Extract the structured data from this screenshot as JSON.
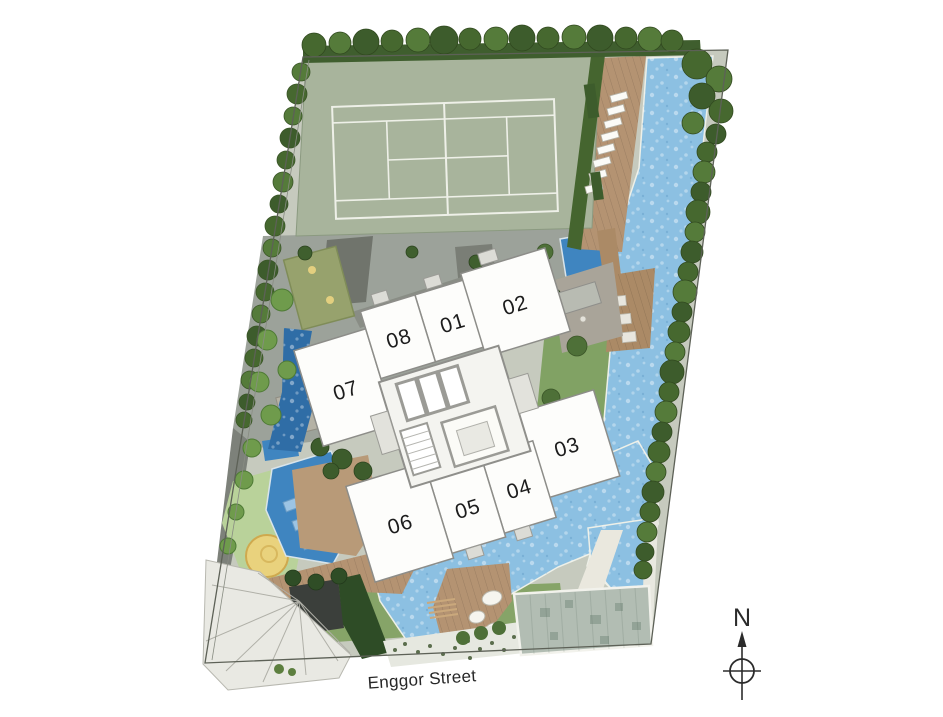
{
  "labels": {
    "street": "Enggor Street",
    "north": "N"
  },
  "units": [
    {
      "id": "01",
      "label": "01"
    },
    {
      "id": "02",
      "label": "02"
    },
    {
      "id": "03",
      "label": "03"
    },
    {
      "id": "04",
      "label": "04"
    },
    {
      "id": "05",
      "label": "05"
    },
    {
      "id": "06",
      "label": "06"
    },
    {
      "id": "07",
      "label": "07"
    },
    {
      "id": "08",
      "label": "08"
    }
  ],
  "palette": {
    "water": "#8cc0e2",
    "water_deep": "#3f85c0",
    "court": "#a8b49c",
    "lawn": "#81a264",
    "kids_lawn": "#b9d29a",
    "deck": "#b49372",
    "paving": "#9ca29a",
    "plaza": "#e9e9e3",
    "canopy": "#b2bdb3",
    "sand": "#e9d27d",
    "unit_fill": "#fdfdfb",
    "tree": "#46682f"
  }
}
